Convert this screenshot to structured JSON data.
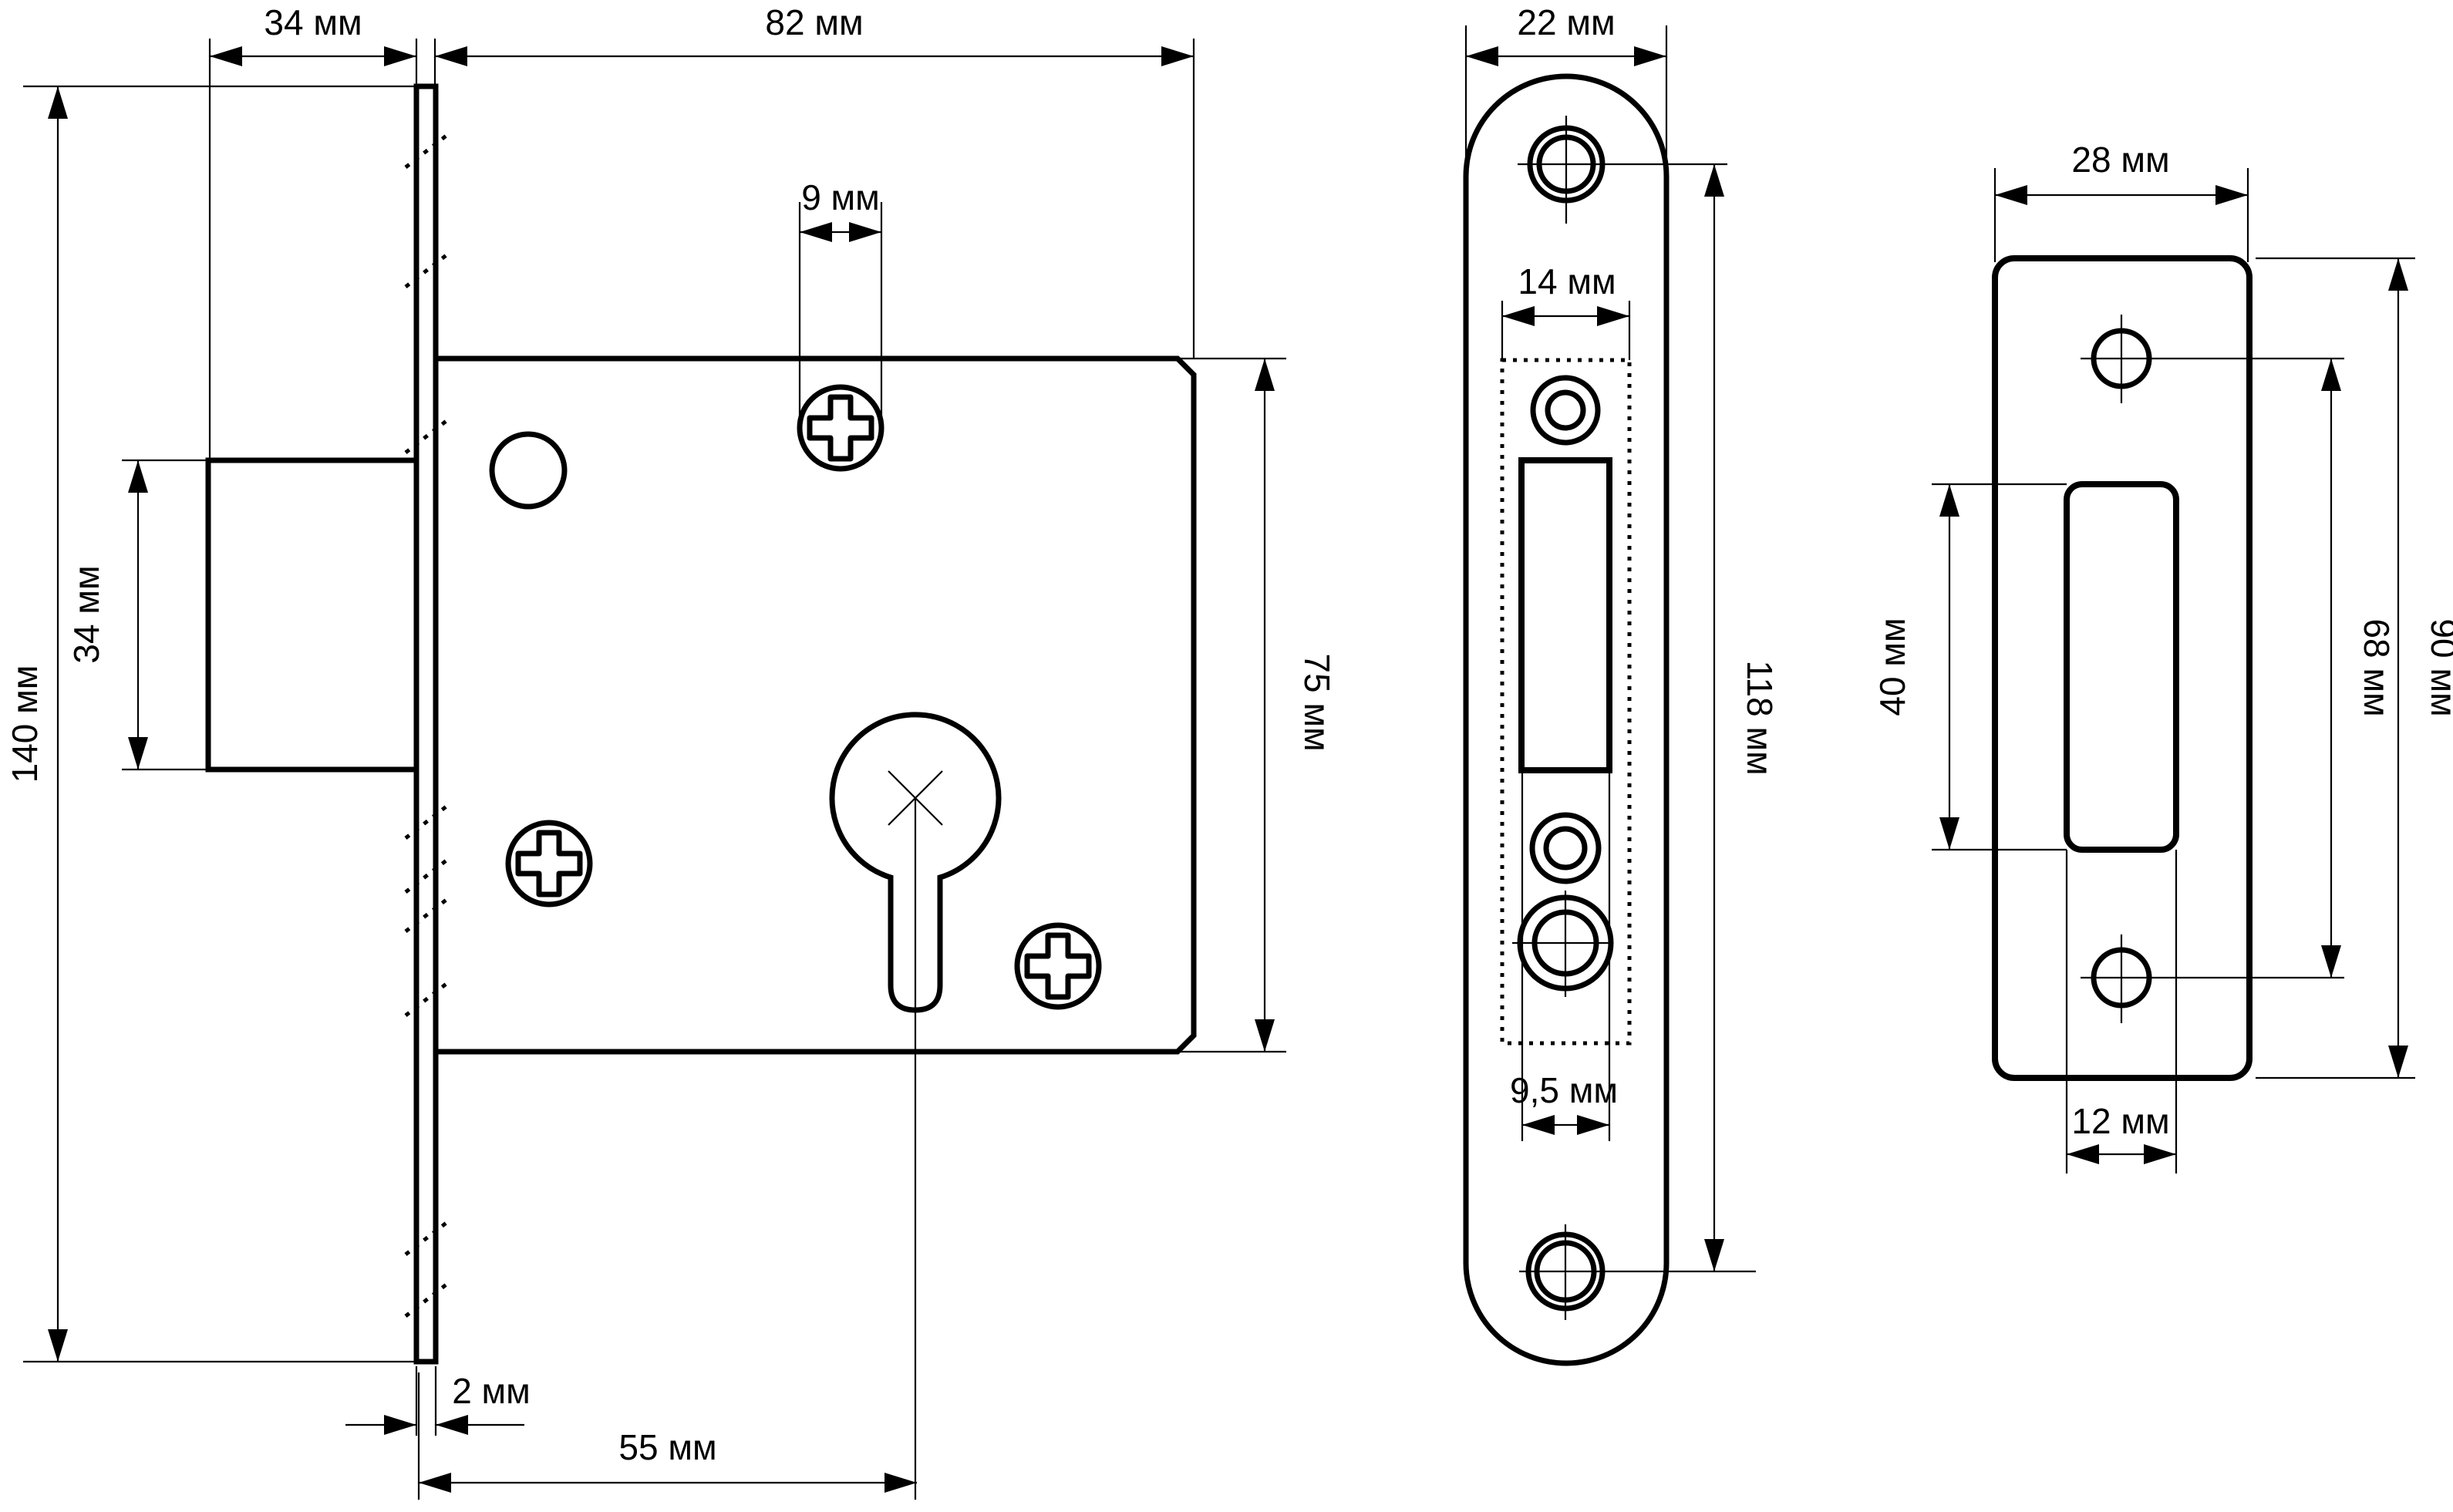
{
  "drawing": {
    "background": "#ffffff",
    "line_color": "#000000",
    "views": {
      "side": {
        "dim_bolt_protrusion": "34 мм",
        "dim_body_depth": "82 мм",
        "dim_screw_hole": "9 мм",
        "dim_overall_height": "140 мм",
        "dim_bolt_height": "34 мм",
        "dim_body_height": "75 мм",
        "dim_faceplate_thickness": "2 мм",
        "dim_backset": "55 мм"
      },
      "faceplate": {
        "dim_width": "22 мм",
        "dim_inner_width": "14 мм",
        "dim_hole_spacing": "118 мм",
        "dim_slot_width": "9,5 мм"
      },
      "strike": {
        "dim_width": "28 мм",
        "dim_cutout_height": "40 мм",
        "dim_hole_spacing": "68 мм",
        "dim_height": "90 мм",
        "dim_cutout_width": "12 мм"
      }
    }
  }
}
